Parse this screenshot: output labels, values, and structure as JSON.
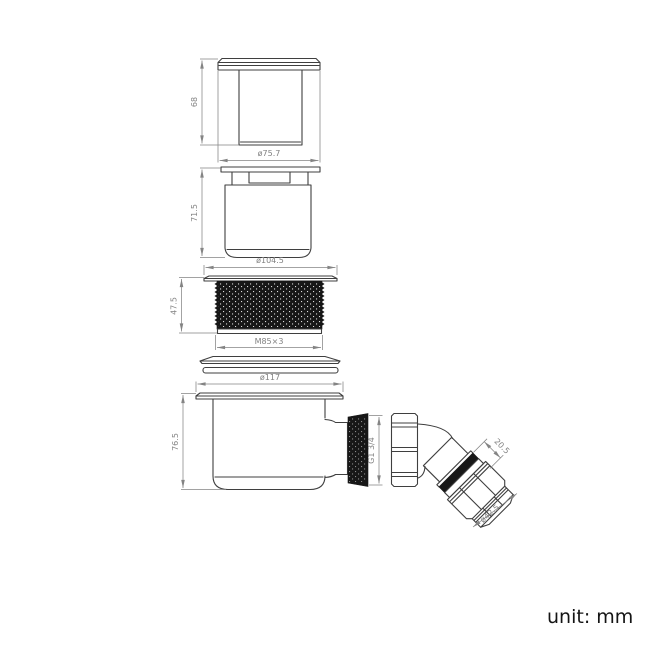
{
  "unit_note": "unit: mm",
  "dimensions": {
    "cap_height": "68",
    "cap_flange_diameter": "ø75.7",
    "insert_height": "71.5",
    "insert_flange_diameter": "ø104.5",
    "thread_height": "47.5",
    "thread_spec": "M85×3",
    "body_flange_diameter": "ø117",
    "body_height": "76.5",
    "outlet_thread": "G1 3/4",
    "elbow_seal_length": "20.5",
    "elbow_nut_diameter": "ø42.5"
  },
  "colors": {
    "outline": "#3f3f3f",
    "dimension": "#848484",
    "seal_black": "#171717",
    "background": "#ffffff",
    "note_text": "#141414"
  }
}
